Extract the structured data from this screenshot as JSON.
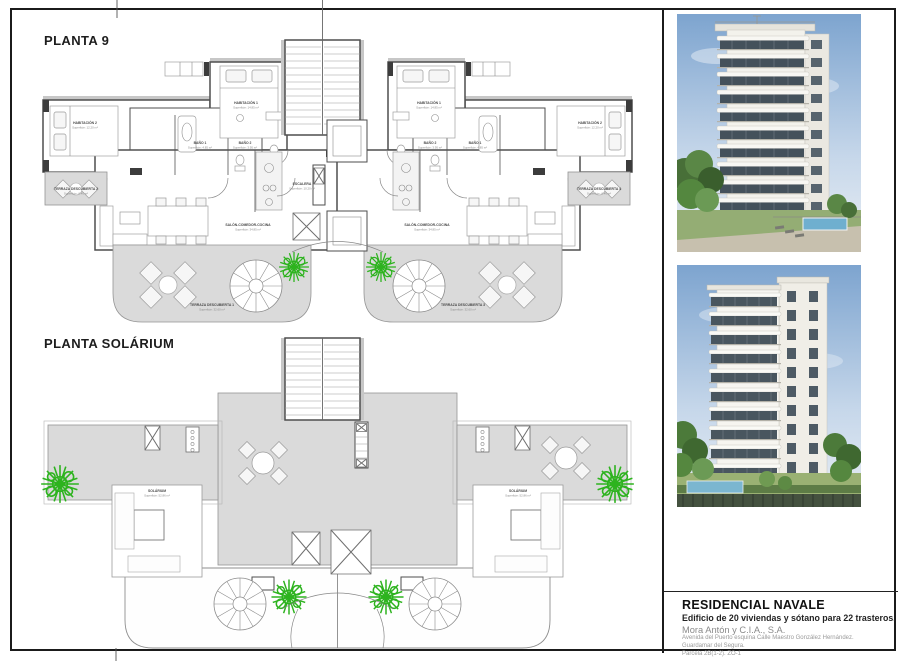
{
  "page": {
    "planta9_title": "PLANTA 9",
    "solarium_title": "PLANTA SOLÁRIUM"
  },
  "planta9": {
    "rooms": [
      {
        "name": "HABITACIÓN 1",
        "area": "Superficie: 14.85 m²"
      },
      {
        "name": "HABITACIÓN 2",
        "area": "Superficie: 12.20 m²"
      },
      {
        "name": "BAÑO 1",
        "area": "Superficie: 4.85 m²"
      },
      {
        "name": "BAÑO 2",
        "area": "Superficie: 3.95 m²"
      },
      {
        "name": "SALÓN-COMEDOR-COCINA",
        "area": "Superficie: 34.85 m²"
      },
      {
        "name": "TERRAZA DESCUBIERTA 1",
        "area": "Superficie: 32.60 m²"
      },
      {
        "name": "TERRAZA DESCUBIERTA 2",
        "area": "Superficie: 6.40 m²"
      },
      {
        "name": "TERRAZA DESCUBIERTA 3",
        "area": "Superficie: 32.60 m²"
      },
      {
        "name": "TERRAZA DESCUBIERTA 4",
        "area": "Superficie: 6.40 m²"
      },
      {
        "name": "ESCALERA",
        "area": "Superficie: 10.20 m²"
      }
    ]
  },
  "solarium": {
    "room": {
      "name": "SOLÁRIUM",
      "area": "Superficie: 52.86 m²"
    }
  },
  "photos": [
    {
      "name": "building-render-front"
    },
    {
      "name": "building-render-side"
    }
  ],
  "title_block": {
    "project": "RESIDENCIAL NAVALE",
    "subtitle": "Edificio de 20 viviendas y sótano para 22 trasteros.",
    "promoter": "Mora Antón y C.I.A., S.A.",
    "address": "Avenida del Puerto esquina Calle Maestro González Hernández.",
    "city": "Guardamar del Segura.",
    "parcel": "Parcela 2B(1-2). ZO-1"
  },
  "colors": {
    "ink": "#1b1b1b",
    "wall_line": "#4e4e4e",
    "terrace_gray": "#dadada",
    "plant_green": "#2db31e",
    "sky_blue": "#7da4cf",
    "lawn_green": "#94ad74",
    "pool_blue": "#6fafcf",
    "muted_text": "#8a8a8a"
  }
}
